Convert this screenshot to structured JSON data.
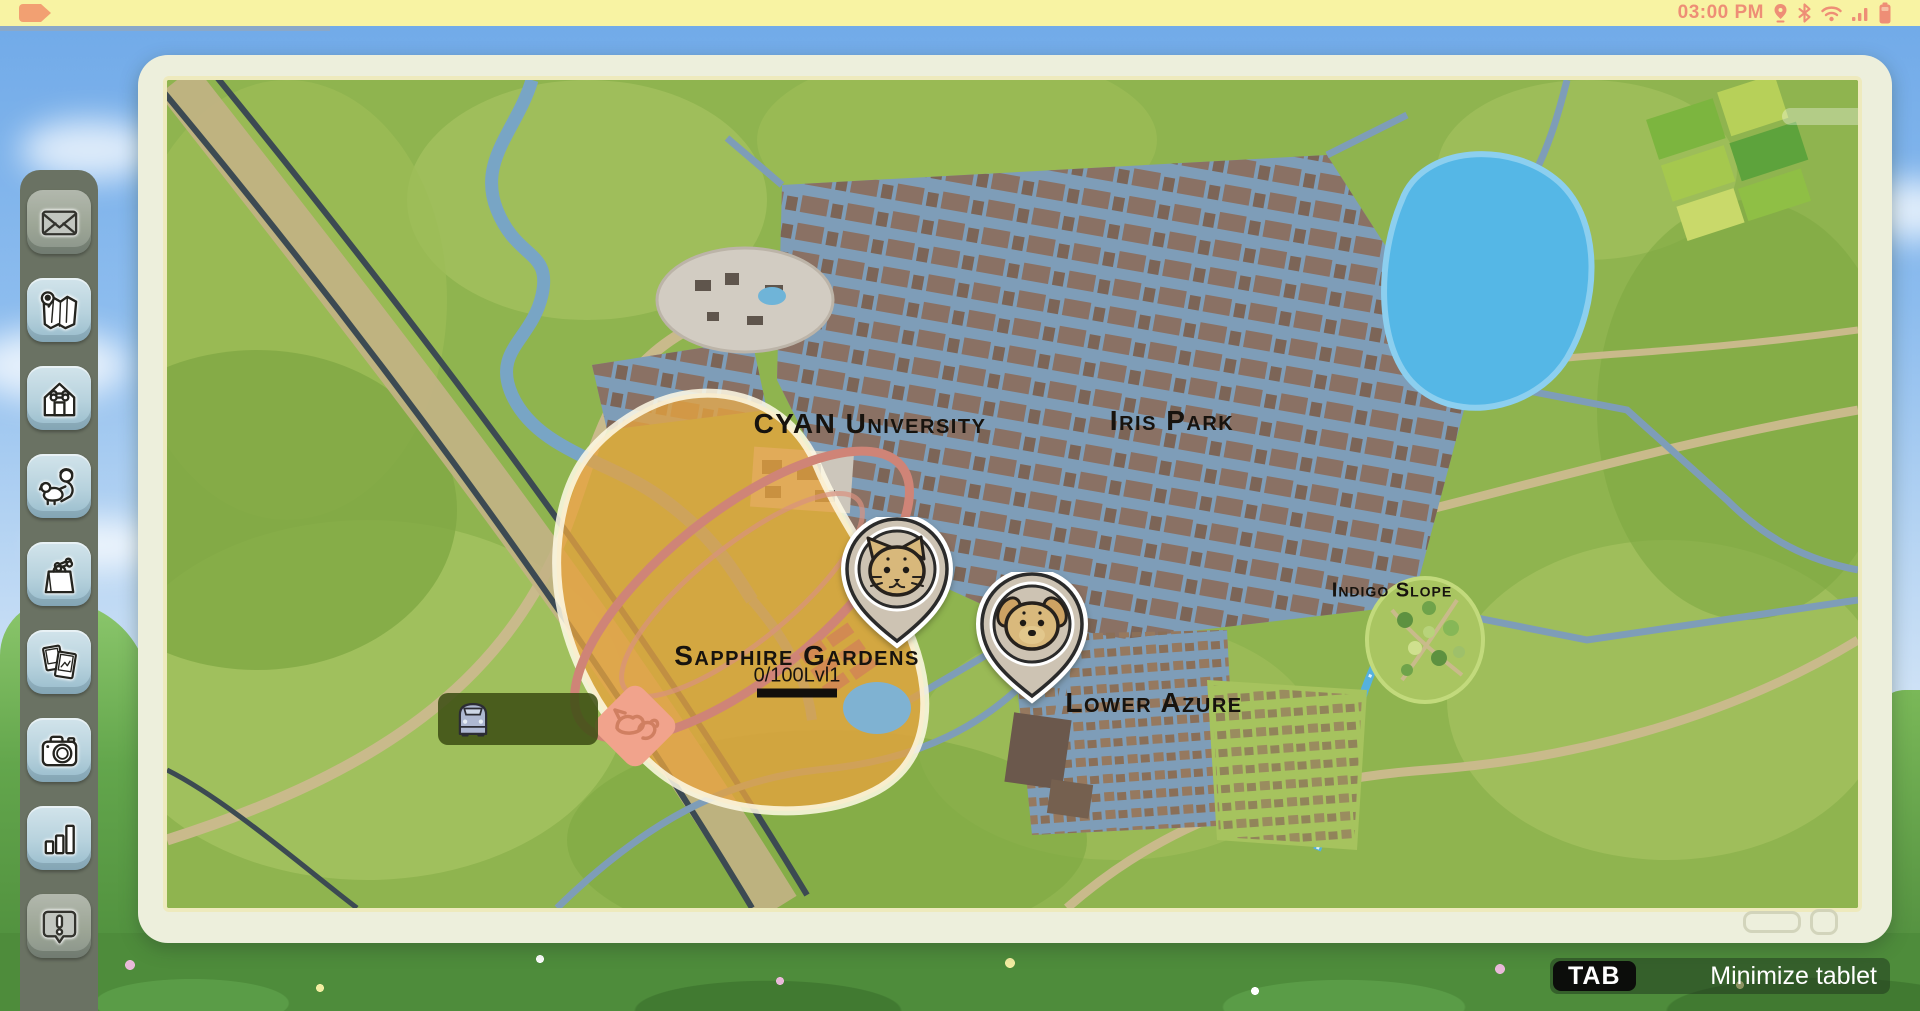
{
  "status_bar": {
    "time": "03:00 PM",
    "bg_color": "#f8f3a3",
    "accent_color": "#ee8e76",
    "tag_color": "#f2a072",
    "icons": [
      "location-icon",
      "bluetooth-icon",
      "wifi-icon",
      "signal-icon",
      "battery-icon"
    ]
  },
  "sidebar": {
    "items": [
      {
        "id": "mail",
        "icon": "envelope-icon",
        "enabled": false
      },
      {
        "id": "map",
        "icon": "map-icon",
        "enabled": true
      },
      {
        "id": "home",
        "icon": "doghouse-icon",
        "enabled": true
      },
      {
        "id": "play",
        "icon": "kid-with-dog-icon",
        "enabled": true
      },
      {
        "id": "shop",
        "icon": "shopping-bag-icon",
        "enabled": true
      },
      {
        "id": "photos",
        "icon": "photo-cards-icon",
        "enabled": true
      },
      {
        "id": "camera",
        "icon": "camera-icon",
        "enabled": true
      },
      {
        "id": "stats",
        "icon": "bar-chart-icon",
        "enabled": true
      },
      {
        "id": "alerts",
        "icon": "alert-bubble-icon",
        "enabled": false
      }
    ]
  },
  "map": {
    "districts": [
      {
        "id": "cyan-university",
        "label": "CYAN University"
      },
      {
        "id": "iris-park",
        "label": "Iris Park"
      },
      {
        "id": "sapphire-gardens",
        "label": "Sapphire Gardens",
        "progress": "0/100Lvl1"
      },
      {
        "id": "lower-azure",
        "label": "Lower Azure"
      },
      {
        "id": "indigo-slope",
        "label": "Indigo Slope"
      }
    ],
    "markers": [
      {
        "id": "cat-marker",
        "icon": "cat-pin-icon"
      },
      {
        "id": "dog-marker",
        "icon": "dog-pin-icon"
      }
    ],
    "vehicle_button": {
      "icon": "car-icon"
    }
  },
  "footer": {
    "key_label": "TAB",
    "action_label": "Minimize tablet"
  }
}
